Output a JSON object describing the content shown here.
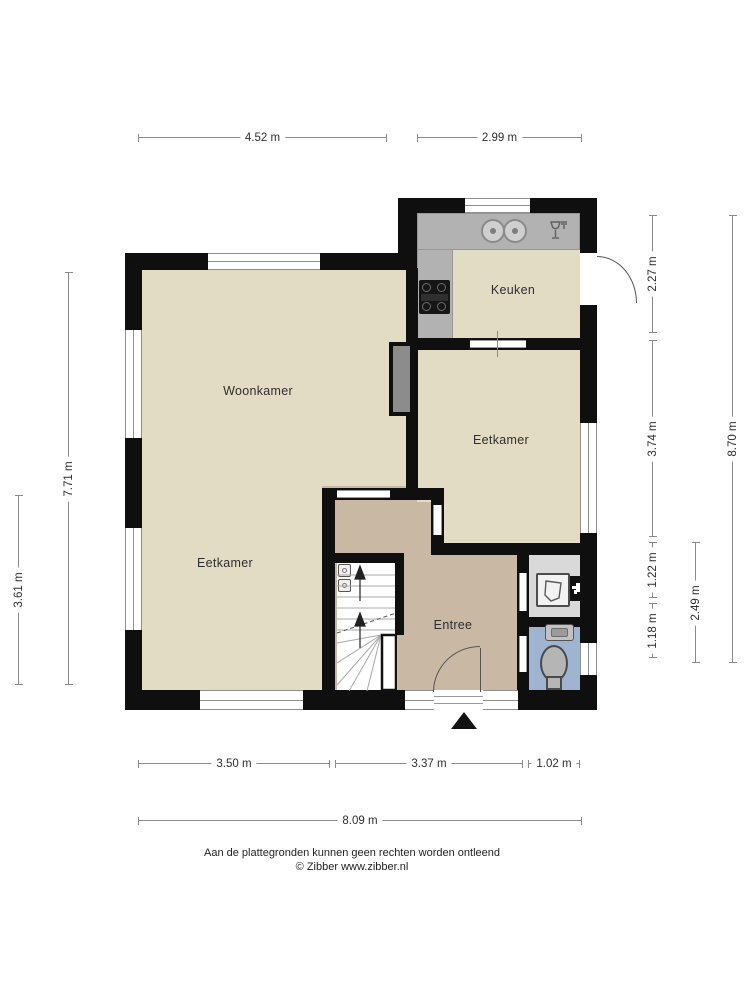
{
  "rooms": {
    "woonkamer": "Woonkamer",
    "keuken": "Keuken",
    "eetkamer_rechts": "Eetkamer",
    "eetkamer_links": "Eetkamer",
    "entree": "Entree"
  },
  "dims": {
    "top1": "4.52 m",
    "top2": "2.99 m",
    "left_inner": "7.71 m",
    "left_outer": "3.61 m",
    "right1": "2.27 m",
    "right2": "3.74 m",
    "right3": "1.22 m",
    "right4": "1.18 m",
    "right_mid": "2.49 m",
    "right_total": "8.70 m",
    "bottom1": "3.50 m",
    "bottom2": "3.37 m",
    "bottom3": "1.02 m",
    "bottom_total": "8.09 m"
  },
  "footer": {
    "disclaimer": "Aan de plattegronden kunnen geen rechten worden ontleend",
    "copyright": "© Zibber www.zibber.nl"
  },
  "icons": {
    "sink": "kitchen-sink-icon",
    "dishwasher": "dishwasher-icon",
    "stove": "stove-icon",
    "boiler": "boiler-icon",
    "tap": "tap-icon",
    "hand_basin": "hand-basin-icon",
    "toilet": "toilet-icon",
    "stairs": "stairs-icon",
    "entrance_marker": "entrance-arrow-icon"
  },
  "colors": {
    "wall_black": "#0f0f0f",
    "floor_cream": "#e3dcc5",
    "entree_tan": "#c9b8a4",
    "toilet_blue": "#9fb4d0",
    "closet_grey": "#d9d9d9",
    "counter_grey": "#b2b2b2",
    "chimney_grey": "#8c8c8c",
    "dimension_grey": "#8a8a8a"
  }
}
